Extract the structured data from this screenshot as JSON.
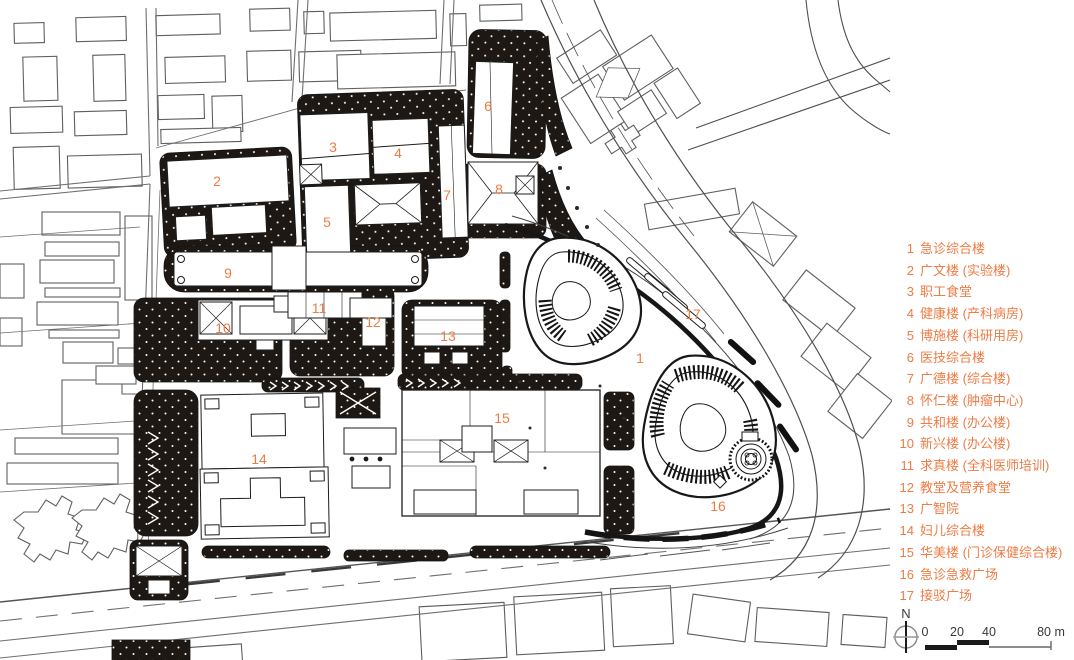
{
  "colors": {
    "accent": "#ED7C45",
    "ink": "#1d1813"
  },
  "legend": {
    "items": [
      {
        "num": "1",
        "name": "急诊综合楼"
      },
      {
        "num": "2",
        "name": "广文楼 (实验楼)"
      },
      {
        "num": "3",
        "name": "职工食堂"
      },
      {
        "num": "4",
        "name": "健康楼 (产科病房)"
      },
      {
        "num": "5",
        "name": "博施楼 (科研用房)"
      },
      {
        "num": "6",
        "name": "医技综合楼"
      },
      {
        "num": "7",
        "name": "广德楼 (综合楼)"
      },
      {
        "num": "8",
        "name": "怀仁楼 (肿瘤中心)"
      },
      {
        "num": "9",
        "name": "共和楼 (办公楼)"
      },
      {
        "num": "10",
        "name": "新兴楼 (办公楼)"
      },
      {
        "num": "11",
        "name": "求真楼 (全科医师培训)"
      },
      {
        "num": "12",
        "name": "教堂及营养食堂"
      },
      {
        "num": "13",
        "name": "广智院"
      },
      {
        "num": "14",
        "name": "妇儿综合楼"
      },
      {
        "num": "15",
        "name": "华美楼 (门诊保健综合楼)"
      },
      {
        "num": "16",
        "name": "急诊急救广场"
      },
      {
        "num": "17",
        "name": "接驳广场"
      }
    ]
  },
  "map_labels": [
    {
      "num": "1",
      "x": 640,
      "y": 358
    },
    {
      "num": "2",
      "x": 217,
      "y": 181
    },
    {
      "num": "3",
      "x": 333,
      "y": 147
    },
    {
      "num": "4",
      "x": 398,
      "y": 153
    },
    {
      "num": "5",
      "x": 327,
      "y": 222
    },
    {
      "num": "6",
      "x": 488,
      "y": 106
    },
    {
      "num": "7",
      "x": 447,
      "y": 195
    },
    {
      "num": "8",
      "x": 499,
      "y": 189
    },
    {
      "num": "9",
      "x": 228,
      "y": 273
    },
    {
      "num": "10",
      "x": 223,
      "y": 328
    },
    {
      "num": "11",
      "x": 319,
      "y": 308
    },
    {
      "num": "12",
      "x": 373,
      "y": 322
    },
    {
      "num": "13",
      "x": 448,
      "y": 336
    },
    {
      "num": "14",
      "x": 259,
      "y": 459
    },
    {
      "num": "15",
      "x": 502,
      "y": 418
    },
    {
      "num": "16",
      "x": 718,
      "y": 506
    },
    {
      "num": "17",
      "x": 693,
      "y": 314
    }
  ],
  "compass": {
    "north_label": "N"
  },
  "scale_bar": {
    "tick0": "0",
    "tick1": "20",
    "tick2": "40",
    "tick3": "80 m"
  }
}
